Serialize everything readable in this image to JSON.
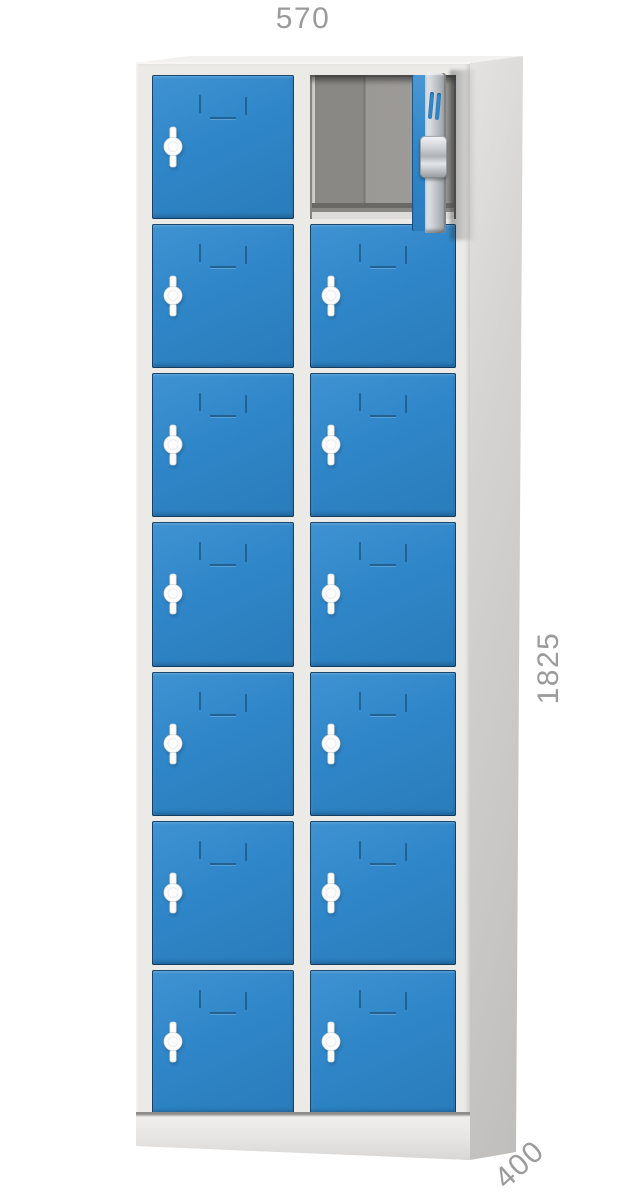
{
  "dimensions": {
    "width": "570",
    "height": "1825",
    "depth": "400"
  },
  "locker": {
    "columns": 2,
    "rows": 7,
    "compartments_total": 14,
    "open_compartment": {
      "row": 1,
      "column": 2
    },
    "features_per_door": [
      "label-slot-emboss",
      "cam-handle"
    ],
    "open_door_features": [
      "vent-slots",
      "cylinder-lock"
    ]
  },
  "colors": {
    "door_blue": "#2f86c8",
    "door_outline": "#0e365a",
    "frame_grey": "#eceae7",
    "side_grey": "#c9c7c5",
    "interior_grey": "#8a8884",
    "handle_white": "#fcfcfc",
    "dimension_text": "#9b9b9b"
  }
}
